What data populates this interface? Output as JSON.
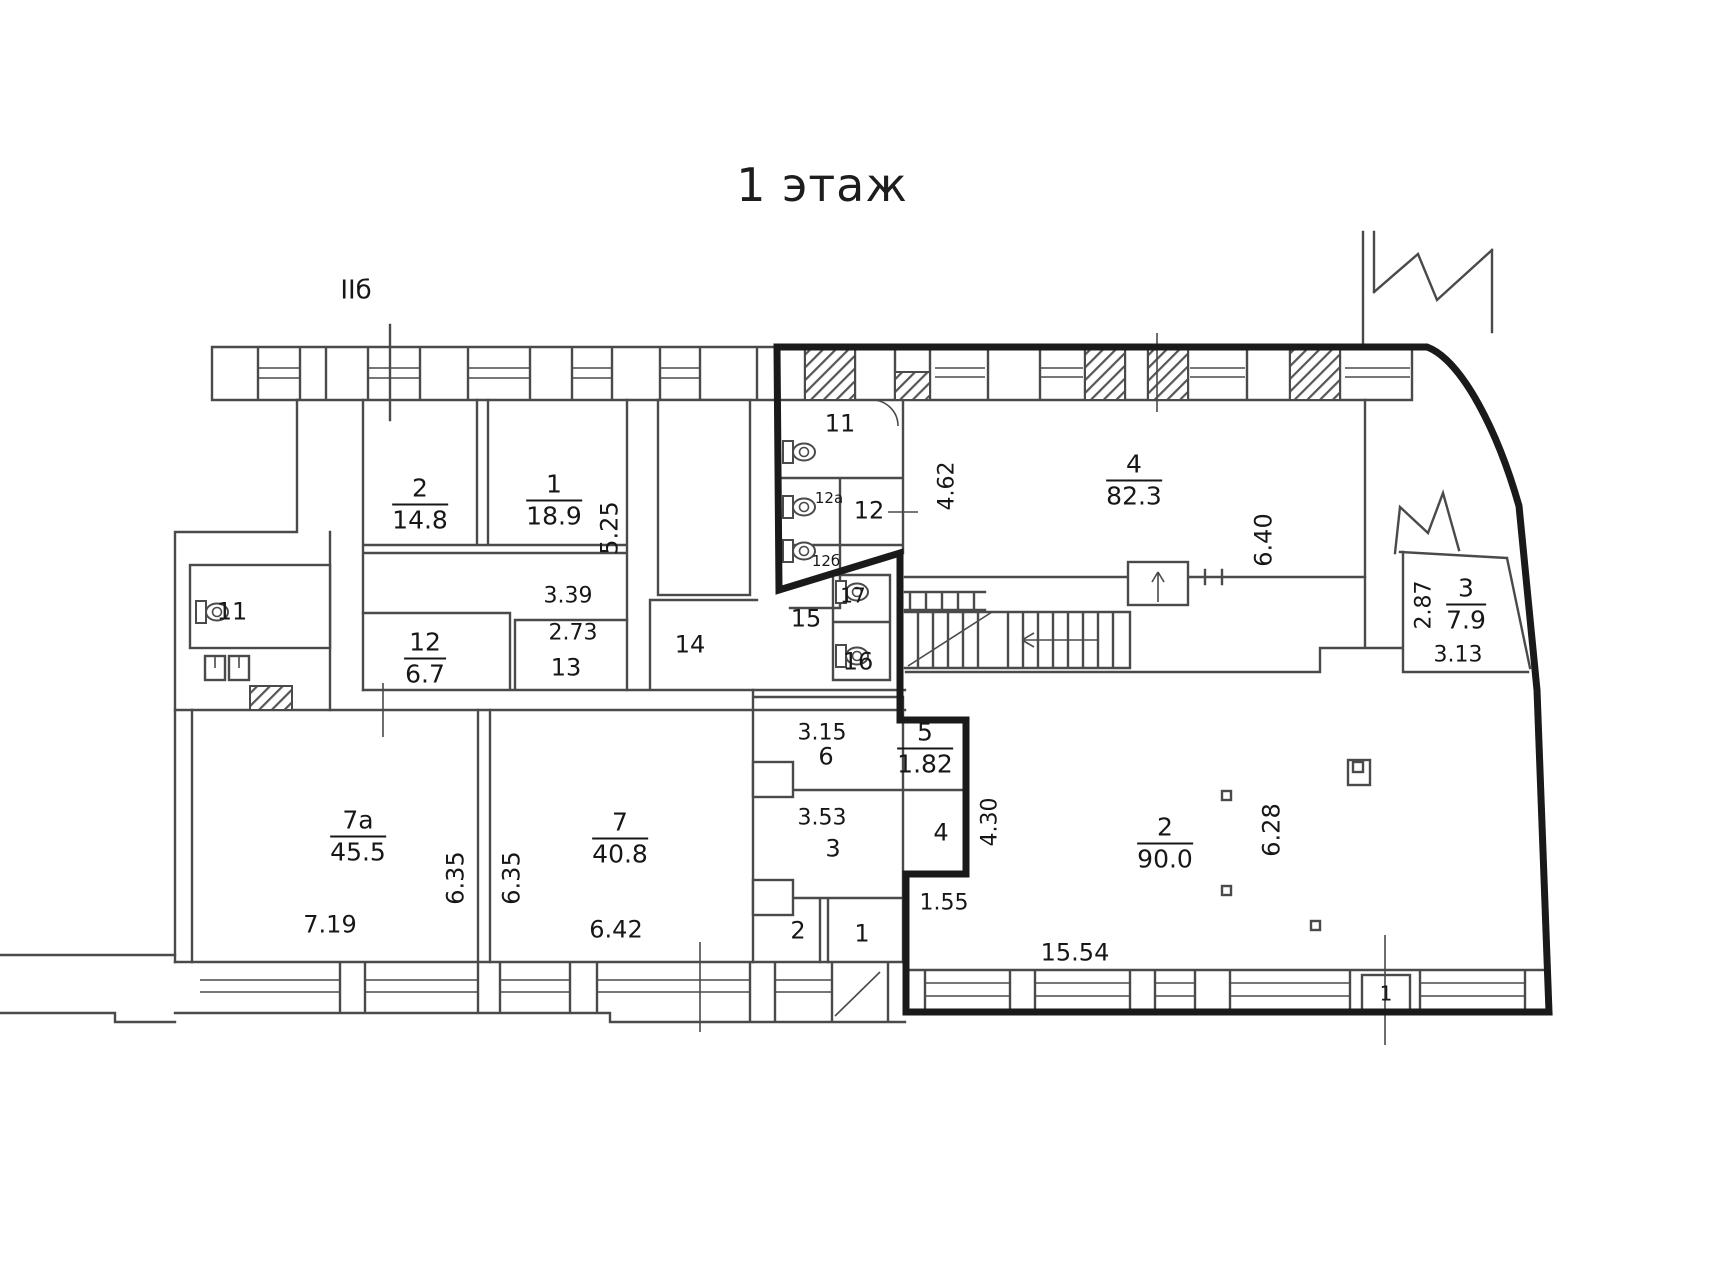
{
  "title": "1 этаж",
  "colors": {
    "wall": "#4a4a4a",
    "thick": "#1a1a1a",
    "text": "#171717",
    "bg": "#ffffff"
  },
  "rooms": [
    {
      "name": "room-2-label",
      "num": "2",
      "area": "14.8",
      "x": 420,
      "y": 504
    },
    {
      "name": "room-1-label",
      "num": "1",
      "area": "18.9",
      "x": 554,
      "y": 500
    },
    {
      "name": "room-12-label",
      "num": "12",
      "area": "6.7",
      "x": 425,
      "y": 658
    },
    {
      "name": "room-7a-label",
      "num": "7а",
      "area": "45.5",
      "x": 358,
      "y": 836
    },
    {
      "name": "room-7-label",
      "num": "7",
      "area": "40.8",
      "x": 620,
      "y": 838
    },
    {
      "name": "room-4-label",
      "num": "4",
      "area": "82.3",
      "x": 1134,
      "y": 480
    },
    {
      "name": "room-3-right-label",
      "num": "3",
      "area": "7.9",
      "x": 1466,
      "y": 604
    },
    {
      "name": "room-2-main-label",
      "num": "2",
      "area": "90.0",
      "x": 1165,
      "y": 843
    },
    {
      "name": "room-5-label",
      "num": "5",
      "area": "1.82",
      "x": 925,
      "y": 748
    }
  ],
  "marks": [
    {
      "name": "section-mark",
      "text": "IIб",
      "x": 356,
      "y": 291,
      "fs": 26
    },
    {
      "name": "room-11-right-label",
      "text": "11",
      "x": 840,
      "y": 424,
      "fs": 24
    },
    {
      "name": "room-12a-label",
      "text": "12а",
      "x": 829,
      "y": 499,
      "fs": 15
    },
    {
      "name": "room-12-wc-label",
      "text": "12",
      "x": 869,
      "y": 511,
      "fs": 24
    },
    {
      "name": "room-12b-label",
      "text": "12б",
      "x": 826,
      "y": 562,
      "fs": 15
    },
    {
      "name": "room-15-label",
      "text": "15",
      "x": 806,
      "y": 619,
      "fs": 24
    },
    {
      "name": "room-17-label",
      "text": "17",
      "x": 853,
      "y": 596,
      "fs": 20
    },
    {
      "name": "room-16-label",
      "text": "16",
      "x": 858,
      "y": 662,
      "fs": 24
    },
    {
      "name": "room-13-label",
      "text": "13",
      "x": 566,
      "y": 668,
      "fs": 24
    },
    {
      "name": "room-14-label",
      "text": "14",
      "x": 690,
      "y": 645,
      "fs": 24
    },
    {
      "name": "room-11-left-label",
      "text": "11",
      "x": 232,
      "y": 612,
      "fs": 24
    },
    {
      "name": "room-6-label",
      "text": "6",
      "x": 826,
      "y": 757,
      "fs": 24
    },
    {
      "name": "room-3-label",
      "text": "3",
      "x": 833,
      "y": 849,
      "fs": 24
    },
    {
      "name": "room-4-small-label",
      "text": "4",
      "x": 941,
      "y": 833,
      "fs": 24
    },
    {
      "name": "room-2-small-label",
      "text": "2",
      "x": 798,
      "y": 931,
      "fs": 24
    },
    {
      "name": "room-1-small-label",
      "text": "1",
      "x": 862,
      "y": 934,
      "fs": 24
    },
    {
      "name": "window-1-label",
      "text": "1",
      "x": 1386,
      "y": 994,
      "fs": 20
    }
  ],
  "dims": [
    {
      "name": "dim-3-39",
      "text": "3.39",
      "x": 568,
      "y": 596,
      "fs": 22,
      "rot": 0
    },
    {
      "name": "dim-2-73",
      "text": "2.73",
      "x": 573,
      "y": 633,
      "fs": 22,
      "rot": 0
    },
    {
      "name": "dim-5-25",
      "text": "5.25",
      "x": 610,
      "y": 528,
      "fs": 24,
      "rot": 1
    },
    {
      "name": "dim-4-62",
      "text": "4.62",
      "x": 947,
      "y": 486,
      "fs": 22,
      "rot": 1
    },
    {
      "name": "dim-6-40",
      "text": "6.40",
      "x": 1264,
      "y": 540,
      "fs": 24,
      "rot": 1
    },
    {
      "name": "dim-2-87",
      "text": "2.87",
      "x": 1424,
      "y": 605,
      "fs": 22,
      "rot": 1
    },
    {
      "name": "dim-3-13",
      "text": "3.13",
      "x": 1458,
      "y": 655,
      "fs": 22,
      "rot": 0
    },
    {
      "name": "dim-3-15",
      "text": "3.15",
      "x": 822,
      "y": 733,
      "fs": 22,
      "rot": 0
    },
    {
      "name": "dim-3-53",
      "text": "3.53",
      "x": 822,
      "y": 818,
      "fs": 22,
      "rot": 0
    },
    {
      "name": "dim-1-55",
      "text": "1.55",
      "x": 944,
      "y": 903,
      "fs": 22,
      "rot": 0
    },
    {
      "name": "dim-4-30",
      "text": "4.30",
      "x": 990,
      "y": 822,
      "fs": 22,
      "rot": 1
    },
    {
      "name": "dim-6-28",
      "text": "6.28",
      "x": 1272,
      "y": 830,
      "fs": 24,
      "rot": 1
    },
    {
      "name": "dim-6-35-a",
      "text": "6.35",
      "x": 456,
      "y": 878,
      "fs": 24,
      "rot": 1
    },
    {
      "name": "dim-6-35-b",
      "text": "6.35",
      "x": 512,
      "y": 878,
      "fs": 24,
      "rot": 1
    },
    {
      "name": "dim-7-19",
      "text": "7.19",
      "x": 330,
      "y": 925,
      "fs": 24,
      "rot": 0
    },
    {
      "name": "dim-6-42",
      "text": "6.42",
      "x": 616,
      "y": 930,
      "fs": 24,
      "rot": 0
    },
    {
      "name": "dim-15-54",
      "text": "15.54",
      "x": 1075,
      "y": 953,
      "fs": 24,
      "rot": 0
    }
  ]
}
